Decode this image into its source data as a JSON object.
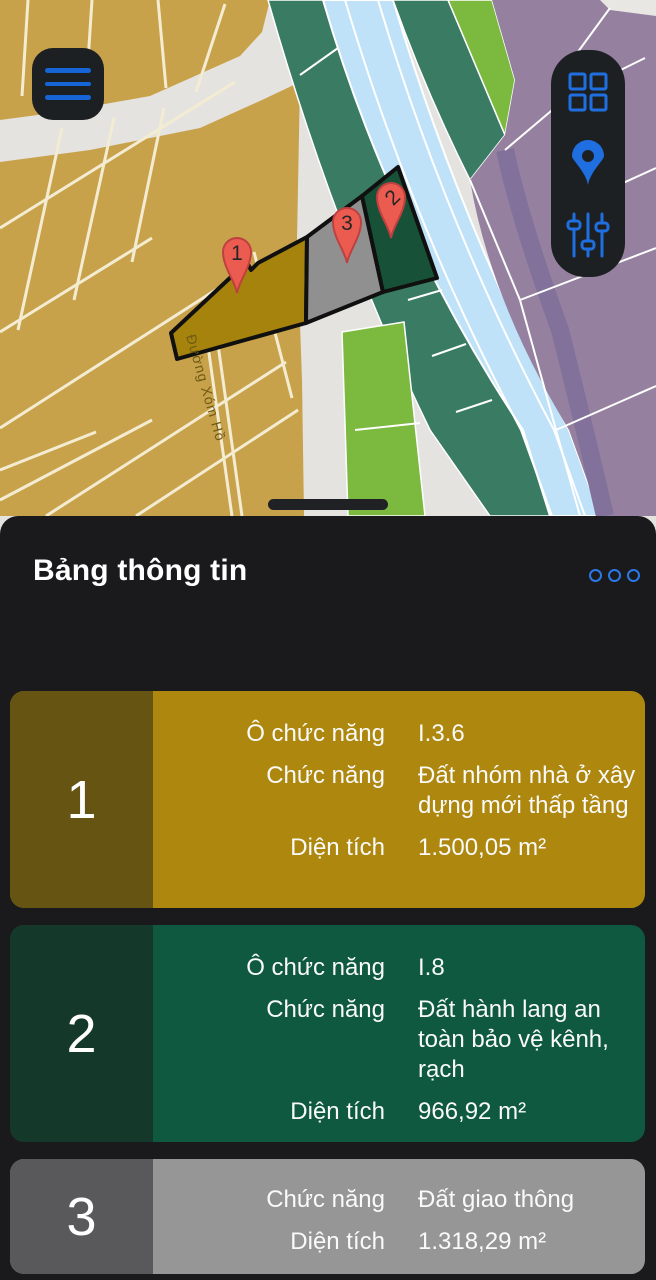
{
  "map": {
    "street_label": "Đường Xóm Hồ",
    "markers": [
      {
        "label": "1"
      },
      {
        "label": "2"
      },
      {
        "label": "3"
      }
    ],
    "controls": {
      "menu": "hamburger-menu",
      "tools": [
        "grid-view",
        "locate-me",
        "layer-filters"
      ]
    },
    "colors": {
      "parcel1": "#a5830c",
      "parcel2": "#175137",
      "parcel3": "#909090",
      "pin_red": "#ec5b50",
      "accent_blue": "#1f6fe0"
    }
  },
  "panel": {
    "title": "Bảng thông tin",
    "cards": [
      {
        "number": "1",
        "band_color": "#665413",
        "body_color": "#ad870e",
        "pad_top": 28,
        "rows": [
          {
            "label": "Ô chức năng",
            "value": "I.3.6"
          },
          {
            "label": "Chức năng",
            "value": "Đất nhóm nhà ở xây dựng mới thấp tầng"
          },
          {
            "label": "Diện tích",
            "value": "1.500,05 m²"
          }
        ]
      },
      {
        "number": "2",
        "band_color": "#14382a",
        "body_color": "#0e5940",
        "pad_top": 28,
        "rows": [
          {
            "label": "Ô chức năng",
            "value": "I.8"
          },
          {
            "label": "Chức năng",
            "value": "Đất hành lang an toàn bảo vệ kênh, rạch"
          },
          {
            "label": "Diện tích",
            "value": "966,92 m²"
          }
        ]
      },
      {
        "number": "3",
        "band_color": "#59595b",
        "body_color": "#969696",
        "pad_top": 26,
        "rows": [
          {
            "label": "Chức năng",
            "value": "Đất giao thông"
          },
          {
            "label": "Diện tích",
            "value": "1.318,29 m²"
          }
        ]
      }
    ]
  }
}
